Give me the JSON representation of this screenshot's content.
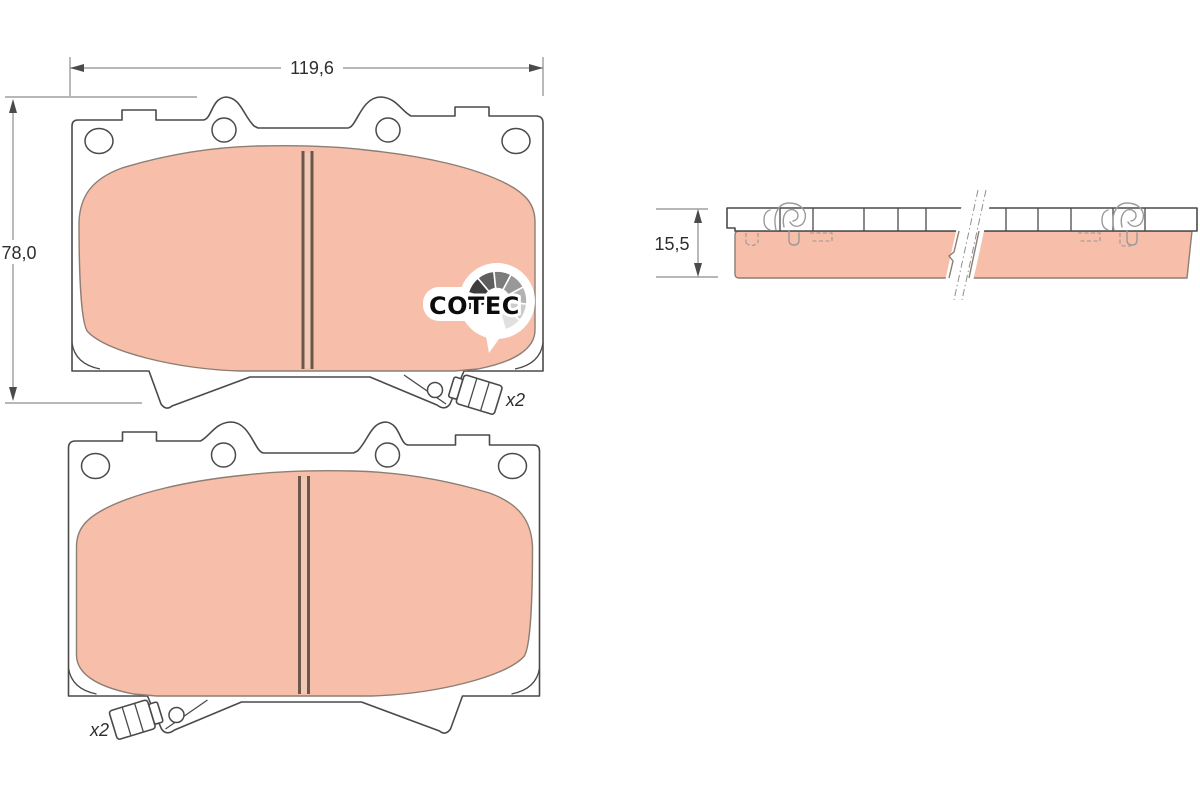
{
  "drawing": {
    "dimensions": {
      "width": "119,6",
      "height": "78,0",
      "thickness": "15,5"
    },
    "labels": {
      "top_pad_quantity": "x2",
      "bottom_pad_quantity": "x2"
    },
    "logo": {
      "text": "COTEC",
      "fan_colors": [
        "#1a1a1a",
        "#3d3d3d",
        "#5e5e5e",
        "#7c7c7c",
        "#989898",
        "#b2b2b2",
        "#cbcbcb",
        "#e0e0e0"
      ]
    },
    "colors": {
      "friction": "#f7bfa9",
      "friction_stripe": "#f2c9b4",
      "friction_outline": "#8c7e74",
      "plate_outline": "#4a4a4a",
      "slot": "#6b584d",
      "dimension_line": "#8c8c8c",
      "annotation_text": "#2e2e2e",
      "clip": "#9a9a9a"
    }
  }
}
